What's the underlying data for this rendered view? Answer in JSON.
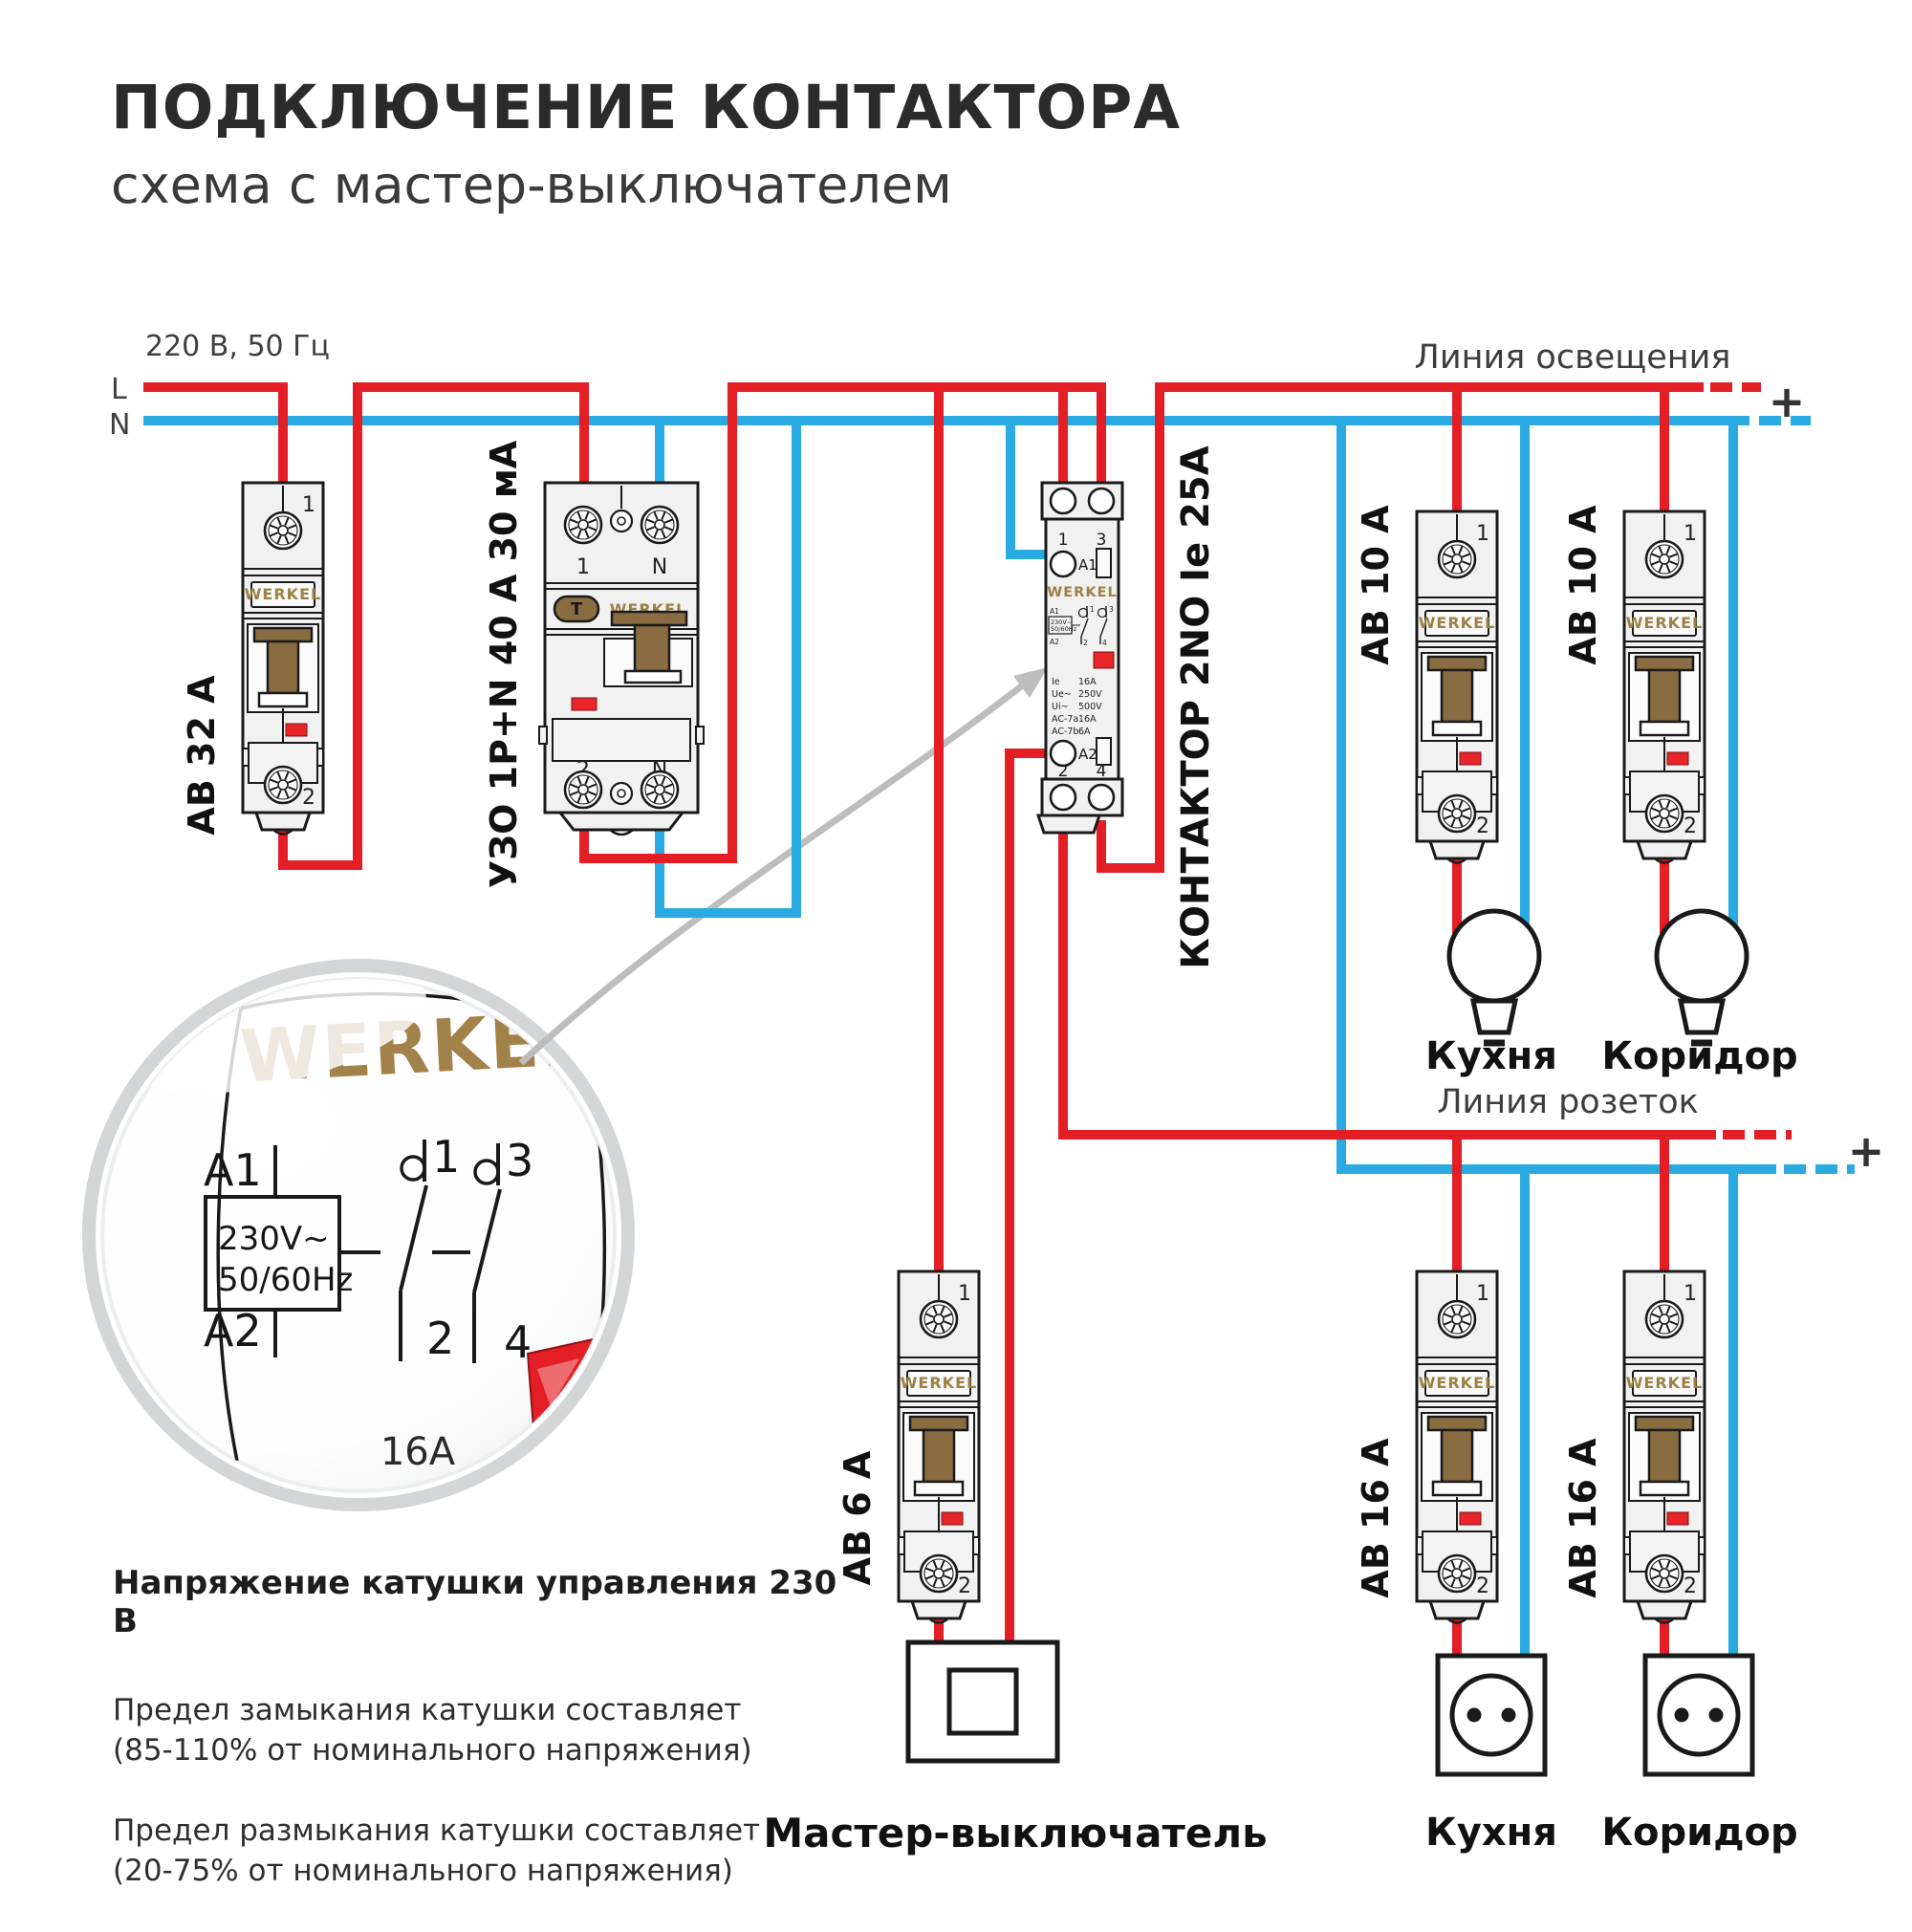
{
  "title": "ПОДКЛЮЧЕНИЕ КОНТАКТОРА",
  "subtitle": "схема с мастер-выключателем",
  "brand": "WERKEL",
  "supply": {
    "label": "220 В, 50 Гц",
    "l": "L",
    "n": "N"
  },
  "lighting_line": {
    "label": "Линия освещения",
    "plus": "+"
  },
  "socket_line": {
    "label": "Линия розеток",
    "plus": "+"
  },
  "breakers": {
    "av32": {
      "label": "АВ 32 А",
      "t1": "1",
      "t2": "2"
    },
    "av10_kitchen": {
      "label": "АВ 10 А",
      "t1": "1",
      "t2": "2"
    },
    "av10_corridor": {
      "label": "АВ 10 А",
      "t1": "1",
      "t2": "2"
    },
    "av6": {
      "label": "АВ 6 А",
      "t1": "1",
      "t2": "2"
    },
    "av16_kitchen": {
      "label": "АВ 16 А",
      "t1": "1",
      "t2": "2"
    },
    "av16_corridor": {
      "label": "АВ 16 А",
      "t1": "1",
      "t2": "2"
    }
  },
  "uzo": {
    "label": "УЗО 1P+N 40 А 30 мА",
    "top": [
      "1",
      "N"
    ],
    "bottom": [
      "2",
      "N"
    ],
    "test": "T"
  },
  "contactor": {
    "label": "КОНТАКТОР 2NO Ie 25А",
    "top": [
      "1",
      "3"
    ],
    "bottom": [
      "2",
      "4"
    ],
    "a1": "A1",
    "a2": "A2",
    "specs": [
      {
        "k": "Ie",
        "v": "16A"
      },
      {
        "k": "Ue~",
        "v": "250V"
      },
      {
        "k": "Ui~",
        "v": "500V"
      },
      {
        "k": "AC-7a",
        "v": "16A"
      },
      {
        "k": "AC-7b",
        "v": "6A"
      }
    ],
    "mini": {
      "a1": "A1",
      "a2": "A2",
      "volt": "230V~",
      "freq": "50/60Hz",
      "c1": "1",
      "c2": "2",
      "c3": "3",
      "c4": "4"
    }
  },
  "loads": {
    "lamp_kitchen": "Кухня",
    "lamp_corridor": "Коридор",
    "socket_kitchen": "Кухня",
    "socket_corridor": "Коридор"
  },
  "master_switch": {
    "label": "Мастер-выключатель"
  },
  "lens": {
    "brand": "WERKEL",
    "a1": "A1",
    "a2": "A2",
    "volt": "230V~",
    "freq": "50/60Hz",
    "c1": "1",
    "c2": "2",
    "c3": "3",
    "c4": "4",
    "rating": "16A"
  },
  "notes": {
    "heading": "Напряжение катушки управления 230 В",
    "p1a": "Предел замыкания катушки составляет",
    "p1b": "(85-110% от номинального напряжения)",
    "p2a": "Предел размыкания катушки составляет",
    "p2b": "(20-75% от номинального напряжения)"
  },
  "colors": {
    "phase": "#e31e24",
    "neutral": "#29abe2",
    "gold": "#9c8144",
    "outline": "#1a1a1a",
    "device_body": "#f1f1f1",
    "lever": "#8a6c42",
    "indicator": "#e8262a",
    "arrow": "#bdbdbd"
  }
}
